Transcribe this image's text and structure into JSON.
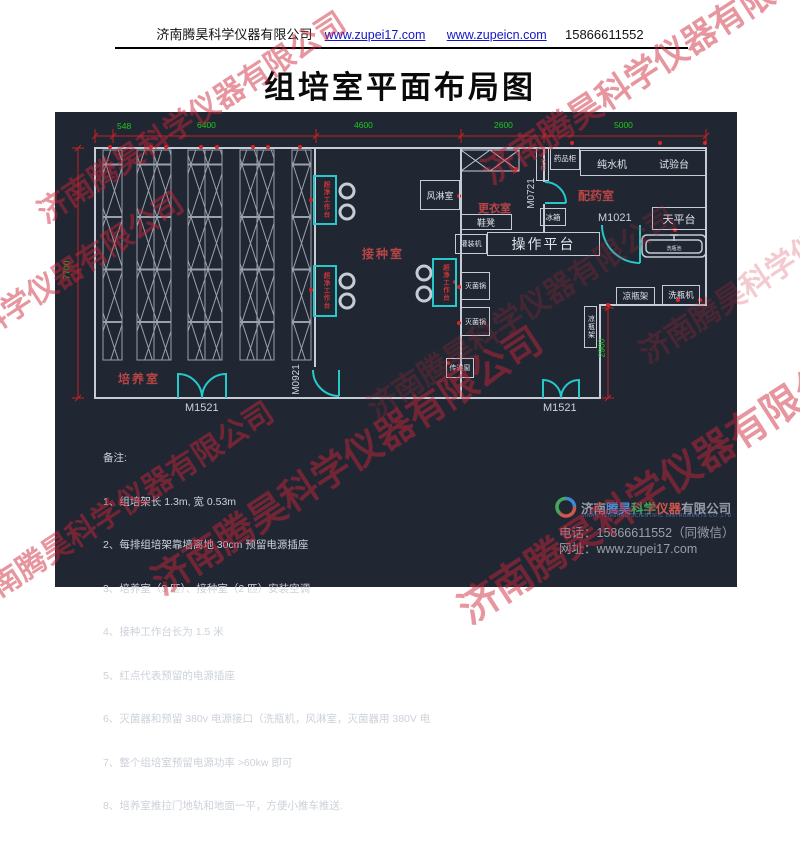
{
  "header": {
    "company": "济南腾昊科学仪器有限公司",
    "link1": "www.zupei17.com",
    "link2": "www.zupeicn.com",
    "phone": "15866611552"
  },
  "title": "组培室平面布局图",
  "watermark": "济南腾昊科学仪器有限公司",
  "plan": {
    "dims": {
      "top": [
        "548",
        "6400",
        "4600",
        "2600",
        "5000"
      ],
      "left": "7700",
      "right": "2900"
    },
    "rooms": {
      "culture": "培养室",
      "inoculation": "接种室",
      "changing": "更衣室",
      "dispensing": "配药室"
    },
    "doors": {
      "m1521": "M1521",
      "m0921": "M0921",
      "m0721": "M0721",
      "m1021": "M1021"
    },
    "bench": "超净工作台",
    "equipment": {
      "air_shower": "风淋室",
      "wardrobe": "衣柜",
      "medicine_cabinet": "药品柜",
      "water_machine": "纯水机",
      "test_bench": "试验台",
      "balance_table": "天平台",
      "bottle_sink": "洗瓶池",
      "fridge": "冰箱",
      "shoe_bench": "鞋凳",
      "filling_machine": "灌装机",
      "operation_platform": "操作平台",
      "sterilizer": "灭菌锅",
      "pass_window": "传递窗",
      "cooling_rack": "凉瓶架",
      "bottle_washer": "洗瓶机"
    },
    "notes": {
      "label": "备注:",
      "items": [
        "1、组培架长 1.3m, 宽 0.53m",
        "2、每排组培架靠墙离地 30cm 预留电源插座",
        "3、培养室（3 匹）、接种室（2 匹）安装空调",
        "4、接种工作台长为 1.5 米",
        "5、红点代表预留的电源插座",
        "6、灭菌器和预留 380v 电源接口（洗瓶机，风淋室，灭菌器用 380V 电",
        "7、整个组培室预留电源功率 >60kw 即可",
        "8、培养室推拉门地轨和地面一平，方便小推车推送."
      ]
    }
  },
  "footer": {
    "brand_jinan": "济南",
    "brand_tenghao": "腾昊",
    "brand_kexue": "科学",
    "brand_yiqi": "仪器",
    "brand_suffix": "有限公司",
    "tagline": "JINAN TENGHAO SCIENTIFIC INSTRUMENTS CO.,LTD",
    "phone": "电话：15866611552（同微信）",
    "site": "网址：www.zupei17.com"
  },
  "colors": {
    "bg": "#202733",
    "wall": "#c6ccd6",
    "dim_red": "#c32222",
    "dim_green": "#21c521",
    "door_teal": "#25c9c9",
    "label_red": "#b84444",
    "watermark_red": "#cd2337"
  }
}
